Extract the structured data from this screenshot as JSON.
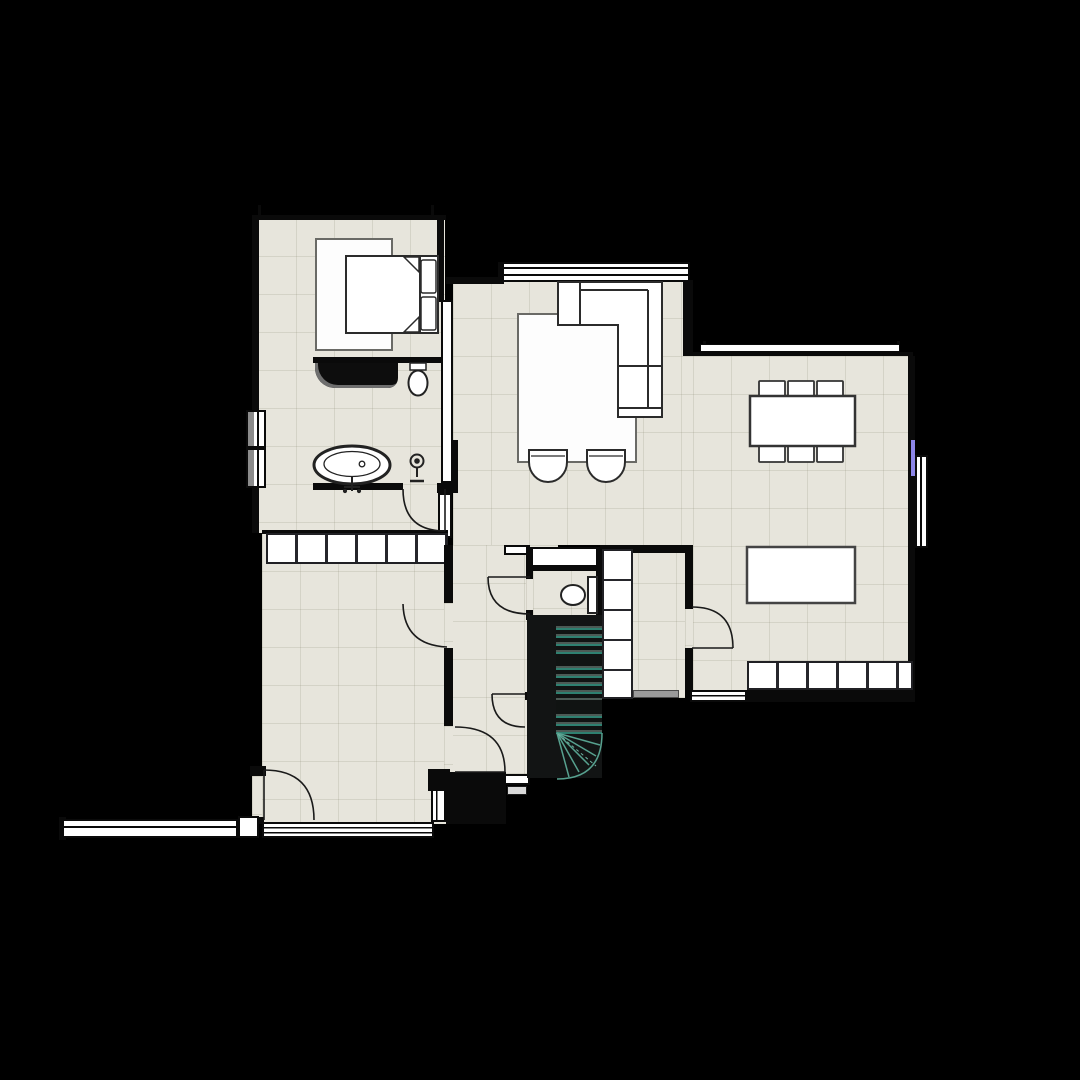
{
  "canvas": {
    "width": 1080,
    "height": 1080,
    "background": "#000000"
  },
  "palette": {
    "floor": "#e7e5dc",
    "floor_grid": "#84806a",
    "wall": "#0a0a0a",
    "fixture_fill": "#ffffff",
    "fixture_stroke": "#2b2b2b",
    "stair_tread_accent": "#2e8070",
    "stair_shaft": "#121414",
    "threshold_gray": "#9a9a9a",
    "accent_marker": "#8d86e8"
  },
  "semantics": {
    "type": "floor-plan",
    "room_ids": [
      "bedroom",
      "bathroom",
      "wardrobe-row",
      "utility-room",
      "hallway",
      "wc",
      "stairwell",
      "entry-vestibule",
      "living-room",
      "dining-kitchen",
      "corridor"
    ],
    "furniture": [
      "double-bed",
      "bedroom-rug",
      "vanity-counter",
      "toilet-bath",
      "freestanding-bathtub",
      "shower-fixture",
      "sectional-sofa",
      "living-rug",
      "armchair",
      "armchair",
      "dining-table",
      "dining-chairs",
      "kitchen-island",
      "cabinet-row",
      "toilet-wc",
      "closet-column",
      "wardrobe-cells",
      "exterior-wall-strip"
    ],
    "counts": {
      "dining_chairs": 6,
      "dining_cabinet_cells": 6,
      "wardrobe_cells": 6,
      "closet_cells": 5,
      "armchairs": 2,
      "door_swings": 7,
      "stair_flight_treads": 14,
      "stair_winder_treads": 5
    },
    "windows": [
      "bath-west-double",
      "living-north-band",
      "dining-north-band",
      "dining-east",
      "dining-south",
      "utility-south-band",
      "entry-sidelight",
      "wc-niche",
      "exterior-strip"
    ],
    "accent_marker_location": "dining-east-wall"
  }
}
